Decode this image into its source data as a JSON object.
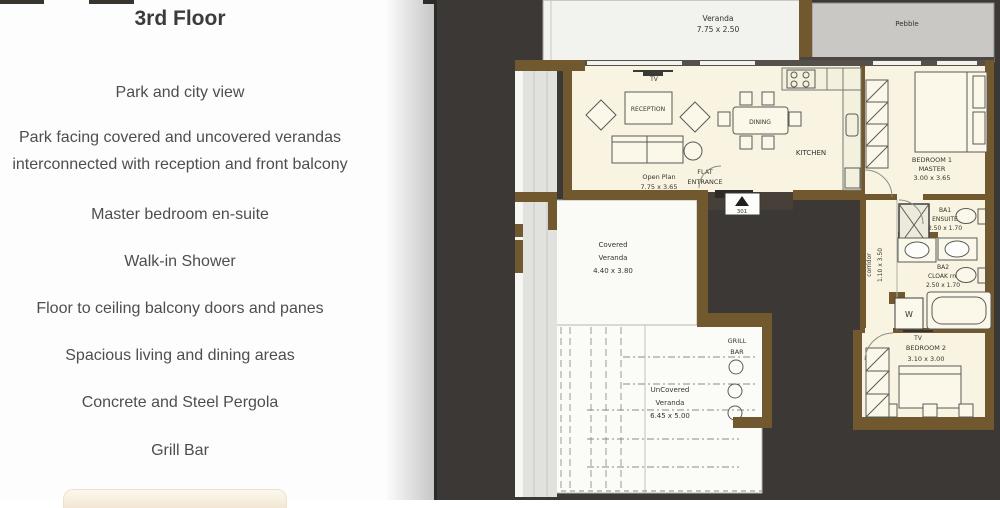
{
  "panel": {
    "title": "3rd Floor",
    "features": [
      "Park and city view",
      "Park facing covered and uncovered verandas interconnected with reception and front balcony",
      "Master bedroom en-suite",
      "Walk-in Shower",
      "Floor to ceiling balcony doors and panes",
      "Spacious living and dining areas",
      "Concrete and Steel Pergola",
      "Grill Bar"
    ]
  },
  "plan": {
    "veranda_top": {
      "name": "Veranda",
      "dims": "7.75 x 2.50"
    },
    "pebble": {
      "name": "Pebble"
    },
    "living": {
      "tv": "TV",
      "reception": "RECEPTION",
      "dining": "DINING",
      "kitchen": "KITCHEN",
      "open_plan": "Open Plan",
      "open_plan_dims": "7.75 x 3.65"
    },
    "entrance": {
      "line1": "FLAT",
      "line2": "ENTRANCE",
      "unit": "301"
    },
    "bedroom1": {
      "line1": "BEDROOM 1",
      "line2": "MASTER",
      "dims": "3.00 x 3.65"
    },
    "ba1": {
      "line1": "BA1",
      "line2": "ENSUITE",
      "dims": "2.50 x 1.70"
    },
    "corridor": {
      "name": "corridor",
      "dims": "1.10 x 3.50"
    },
    "ba2": {
      "line1": "BA2",
      "line2": "CLOAK rm",
      "dims": "2.50 x 1.70"
    },
    "washer": {
      "label": "W"
    },
    "bedroom2": {
      "tv": "TV",
      "line1": "BEDROOM 2",
      "dims": "3.10 x 3.00"
    },
    "covered_veranda": {
      "line1": "Covered",
      "line2": "Veranda",
      "dims": "4.40 x 3.80"
    },
    "grill_bar": {
      "line1": "GRILL",
      "line2": "BAR"
    },
    "uncovered_veranda": {
      "line1": "UnCovered",
      "line2": "Veranda",
      "dims": "6.45 x 5.00"
    }
  },
  "colors": {
    "wall_brown": "#72582f",
    "plan_background": "#3b3835",
    "room_fill": "#f8f4e1",
    "veranda_fill": "#fafaf7",
    "pebble_fill": "#c9c8c5",
    "panel_text": "#4e4e4e"
  }
}
